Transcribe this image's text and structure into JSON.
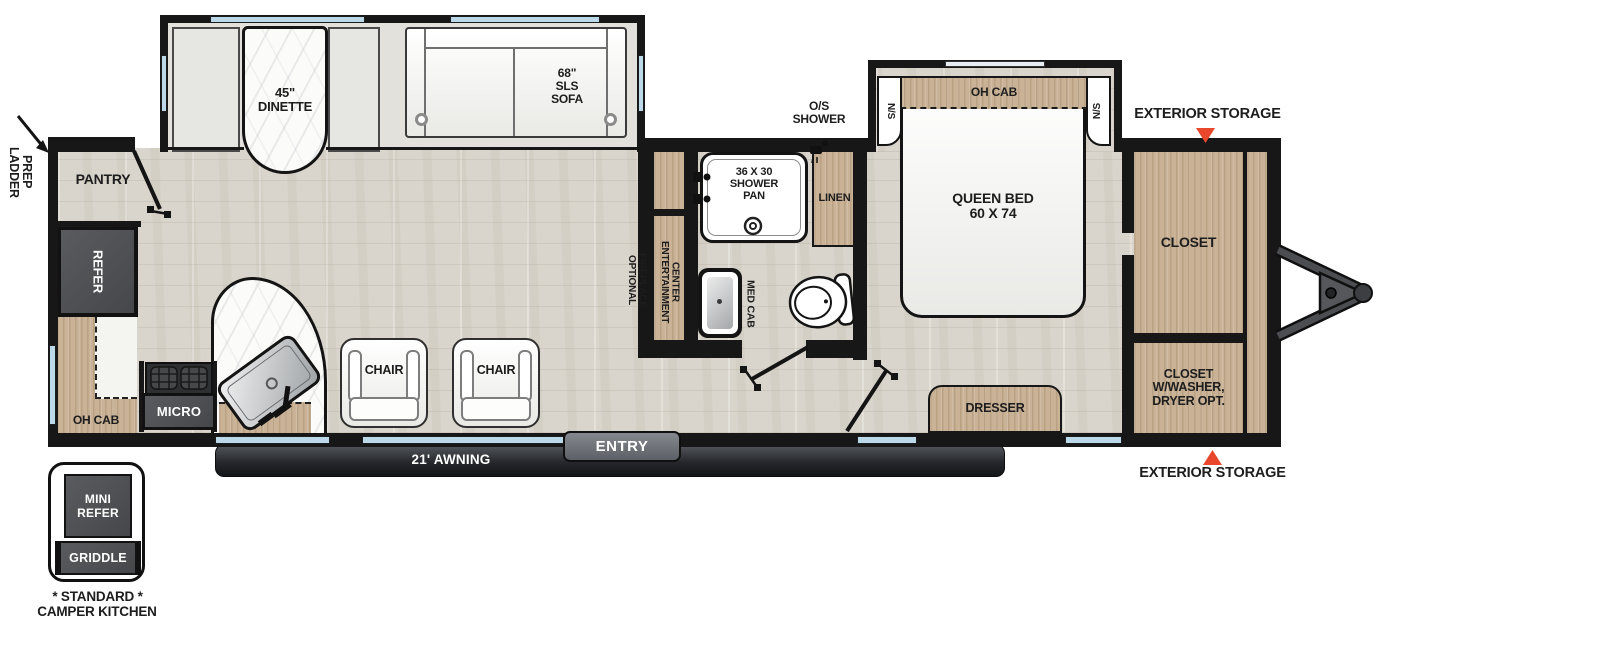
{
  "colors": {
    "wall": "#171717",
    "wood": "#c9b296",
    "floor": "#d9d5cc",
    "appliance_dark": "#4f5052",
    "window_blue": "#bcd9ea",
    "accent_red": "#e8472b",
    "marble": "#fbfbf9",
    "awning_dark": "#26282d"
  },
  "exterior": {
    "ladder_prep": [
      "LADDER",
      "PREP"
    ],
    "exterior_storage_top": "EXTERIOR STORAGE",
    "exterior_storage_bottom": "EXTERIOR STORAGE",
    "awning": "21' AWNING",
    "entry": "ENTRY"
  },
  "kitchen": {
    "pantry": "PANTRY",
    "refer": "REFER",
    "oh_cab": "OH CAB",
    "micro": "MICRO"
  },
  "living": {
    "dinette": [
      "45\"",
      "DINETTE"
    ],
    "sofa": [
      "68\"",
      "SLS",
      "SOFA"
    ],
    "chair_left": "CHAIR",
    "chair_right": "CHAIR",
    "optional_fireplace": [
      "OPTIONAL",
      "FIREPLACE"
    ],
    "entertainment_center": [
      "ENTERTAINMENT",
      "CENTER"
    ]
  },
  "bath": {
    "os_shower": [
      "O/S",
      "SHOWER"
    ],
    "shower_pan": [
      "36 X 30",
      "SHOWER",
      "PAN"
    ],
    "linen": "LINEN",
    "med_cab": "MED CAB"
  },
  "bedroom": {
    "queen_bed": [
      "QUEEN BED",
      "60 X 74"
    ],
    "oh_cab": "OH CAB",
    "ns_left": "N/S",
    "ns_right": "N/S",
    "dresser": "DRESSER"
  },
  "front": {
    "closet": "CLOSET",
    "closet_washer": [
      "CLOSET",
      "W/WASHER,",
      "DRYER OPT."
    ]
  },
  "camper_kitchen": {
    "mini_refer": [
      "MINI",
      "REFER"
    ],
    "griddle": "GRIDDLE",
    "caption": [
      "* STANDARD *",
      "CAMPER KITCHEN"
    ]
  }
}
